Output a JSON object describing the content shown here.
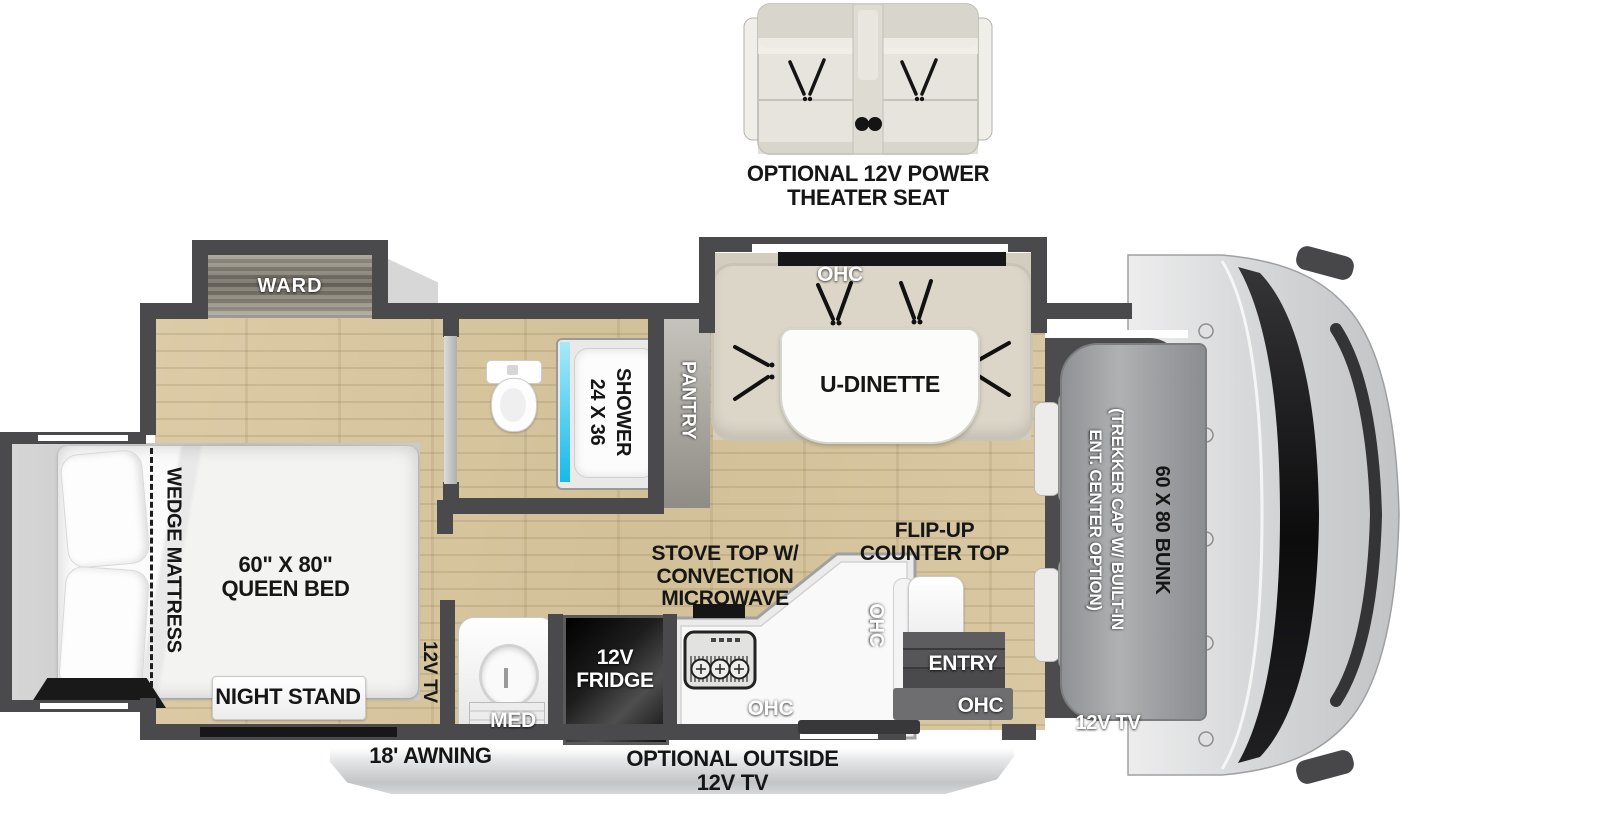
{
  "fp": {
    "theater_line1": "OPTIONAL 12V POWER",
    "theater_line2": "THEATER SEAT",
    "ward": "WARD",
    "wedge": "WEDGE MATTRESS",
    "queen1": "60\" X 80\"",
    "queen2": "QUEEN BED",
    "nightstand": "NIGHT STAND",
    "tv_bedroom": "12V TV",
    "med": "MED",
    "fridge1": "12V",
    "fridge2": "FRIDGE",
    "shower1": "24 X 36",
    "shower2": "SHOWER",
    "pantry": "PANTRY",
    "ohc": "OHC",
    "udinette": "U-DINETTE",
    "stove1": "STOVE TOP W/",
    "stove2": "CONVECTION",
    "stove3": "MICROWAVE",
    "flip1": "FLIP-UP",
    "flip2": "COUNTER TOP",
    "entry": "ENTRY",
    "trekker1": "(TREKKER CAP W/ BUILT-IN",
    "trekker2": "ENT. CENTER OPTION)",
    "bunk": "60 X 80 BUNK",
    "tv_front": "12V TV",
    "awning": "18' AWNING",
    "outside1": "OPTIONAL OUTSIDE",
    "outside2": "12V TV"
  },
  "colors": {
    "wall": "#4a4a4c",
    "floor_wood": "#d8c7a2",
    "shower_glass": "#2ec2ec",
    "label_dark": "#161616"
  }
}
